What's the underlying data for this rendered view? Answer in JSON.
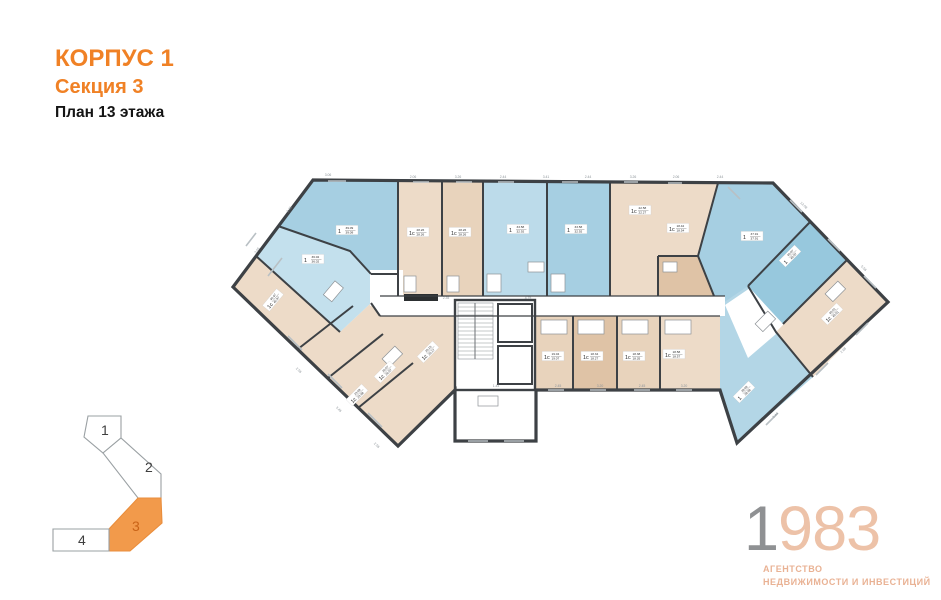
{
  "header": {
    "building": "КОРПУС 1",
    "section": "Секция 3",
    "floor": "План 13 этажа"
  },
  "plan": {
    "colors": {
      "wall": "#3d4145",
      "blue": "#a6cfe2",
      "blue_light": "#c3e0ed",
      "beige": "#eddbc8",
      "tan": "#dfc3a6",
      "accent": "#f08125"
    },
    "apartments": [
      {
        "id": "W1",
        "type": "1",
        "area_top": "39.09",
        "area_bottom": "39.09",
        "x": 119,
        "y": 64,
        "rot": 0,
        "fill": "#a6cfe2"
      },
      {
        "id": "W2",
        "type": "1",
        "area_top": "36.02",
        "area_bottom": "36.02",
        "x": 85,
        "y": 93,
        "rot": 0,
        "fill": "#c3e0ed"
      },
      {
        "id": "W3",
        "type": "1с",
        "area_top": "40.97",
        "area_bottom": "40.97",
        "x": 45,
        "y": 134,
        "rot": -50,
        "fill": "#eddbc8"
      },
      {
        "id": "T1",
        "type": "1с",
        "area_top": "28.26",
        "area_bottom": "28.26",
        "x": 190,
        "y": 66,
        "rot": 0,
        "fill": "#eddbc8"
      },
      {
        "id": "T2",
        "type": "1с",
        "area_top": "28.26",
        "area_bottom": "28.26",
        "x": 232,
        "y": 66,
        "rot": 0,
        "fill": "#e8d3bc"
      },
      {
        "id": "T3",
        "type": "1",
        "area_top": "33.58",
        "area_bottom": "32.92",
        "x": 290,
        "y": 63,
        "rot": 0,
        "fill": "#bcdbea"
      },
      {
        "id": "T4",
        "type": "1",
        "area_top": "33.58",
        "area_bottom": "32.92",
        "x": 348,
        "y": 63,
        "rot": 0,
        "fill": "#a6cfe2"
      },
      {
        "id": "T5",
        "type": "1с",
        "area_top": "22.58",
        "area_bottom": "22.27",
        "x": 412,
        "y": 44,
        "rot": 0,
        "fill": "#eddbc8"
      },
      {
        "id": "T6",
        "type": "1с",
        "area_top": "18.42",
        "area_bottom": "18.54",
        "x": 450,
        "y": 62,
        "rot": 0,
        "fill": "#dfc3a6"
      },
      {
        "id": "R1",
        "type": "1",
        "area_top": "37.91",
        "area_bottom": "37.91",
        "x": 524,
        "y": 70,
        "rot": 0,
        "fill": "#a6cfe2"
      },
      {
        "id": "R2",
        "type": "1",
        "area_top": "40.07",
        "area_bottom": "40.07",
        "x": 562,
        "y": 90,
        "rot": -45,
        "fill": "#97c8dd"
      },
      {
        "id": "R3",
        "type": "1с",
        "area_top": "40.51",
        "area_bottom": "40.51",
        "x": 604,
        "y": 148,
        "rot": -45,
        "fill": "#eddbc8"
      },
      {
        "id": "R4",
        "type": "1",
        "area_top": "39.69",
        "area_bottom": "39.69",
        "x": 516,
        "y": 226,
        "rot": -45,
        "fill": "#b3d6e6"
      },
      {
        "id": "B1",
        "type": "1с",
        "area_top": "23.68",
        "area_bottom": "23.68",
        "x": 129,
        "y": 229,
        "rot": -45,
        "fill": "#eddbc8"
      },
      {
        "id": "B2",
        "type": "1с",
        "area_top": "26.57",
        "area_bottom": "26.57",
        "x": 157,
        "y": 206,
        "rot": -45,
        "fill": "#eddbc8"
      },
      {
        "id": "B3",
        "type": "1с",
        "area_top": "25.15",
        "area_bottom": "25.17",
        "x": 200,
        "y": 186,
        "rot": -45,
        "fill": "#eddbc8"
      },
      {
        "id": "B4",
        "type": "1с",
        "area_top": "19.04",
        "area_bottom": "19.07",
        "x": 325,
        "y": 190,
        "rot": 0,
        "fill": "#e8d3bc"
      },
      {
        "id": "B5",
        "type": "1с",
        "area_top": "18.34",
        "area_bottom": "18.27",
        "x": 364,
        "y": 190,
        "rot": 0,
        "fill": "#dfc3a6"
      },
      {
        "id": "B6",
        "type": "1с",
        "area_top": "18.38",
        "area_bottom": "18.35",
        "x": 406,
        "y": 190,
        "rot": 0,
        "fill": "#e8d3bc"
      },
      {
        "id": "B7",
        "type": "1с",
        "area_top": "18.58",
        "area_bottom": "18.57",
        "x": 446,
        "y": 188,
        "rot": 0,
        "fill": "#eddbc8"
      }
    ],
    "dimensions": [
      {
        "t": "2.06",
        "x": 185,
        "y": 12,
        "rot": 0
      },
      {
        "t": "3.26",
        "x": 230,
        "y": 12,
        "rot": 0
      },
      {
        "t": "2.44",
        "x": 275,
        "y": 12,
        "rot": 0
      },
      {
        "t": "3.41",
        "x": 318,
        "y": 12,
        "rot": 0
      },
      {
        "t": "2.44",
        "x": 360,
        "y": 12,
        "rot": 0
      },
      {
        "t": "3.26",
        "x": 405,
        "y": 12,
        "rot": 0
      },
      {
        "t": "2.06",
        "x": 448,
        "y": 12,
        "rot": 0
      },
      {
        "t": "2.44",
        "x": 492,
        "y": 12,
        "rot": 0
      },
      {
        "t": "3.06",
        "x": 100,
        "y": 10,
        "rot": 0
      },
      {
        "t": "12.08",
        "x": 575,
        "y": 40,
        "rot": 45
      },
      {
        "t": "5.56",
        "x": 635,
        "y": 103,
        "rot": 45
      },
      {
        "t": "3.05",
        "x": 30,
        "y": 85,
        "rot": -53
      },
      {
        "t": "2.46",
        "x": 62,
        "y": 44,
        "rot": -53
      },
      {
        "t": "2.45",
        "x": 330,
        "y": 221,
        "rot": 0
      },
      {
        "t": "3.20",
        "x": 372,
        "y": 221,
        "rot": 0
      },
      {
        "t": "2.45",
        "x": 414,
        "y": 221,
        "rot": 0
      },
      {
        "t": "3.20",
        "x": 456,
        "y": 221,
        "rot": 0
      },
      {
        "t": "1.44",
        "x": 268,
        "y": 221,
        "rot": 0
      },
      {
        "t": "4.75",
        "x": 300,
        "y": 133,
        "rot": 0
      },
      {
        "t": "2.35",
        "x": 218,
        "y": 133,
        "rot": 0
      },
      {
        "t": "2.56",
        "x": 70,
        "y": 205,
        "rot": 44
      },
      {
        "t": "3.46",
        "x": 110,
        "y": 244,
        "rot": 44
      },
      {
        "t": "2.56",
        "x": 148,
        "y": 280,
        "rot": 44
      },
      {
        "t": "3.44",
        "x": 548,
        "y": 250,
        "rot": -45
      },
      {
        "t": "2.08",
        "x": 616,
        "y": 185,
        "rot": -45
      }
    ]
  },
  "minimap": {
    "sections": [
      {
        "label": "1"
      },
      {
        "label": "2"
      },
      {
        "label": "3"
      },
      {
        "label": "4"
      }
    ],
    "active_section": "3"
  },
  "logo": {
    "year_digit1": "1",
    "year_rest": "983",
    "tagline_line1": "АГЕНТСТВО",
    "tagline_line2": "НЕДВИЖИМОСТИ И ИНВЕСТИЦИЙ"
  }
}
